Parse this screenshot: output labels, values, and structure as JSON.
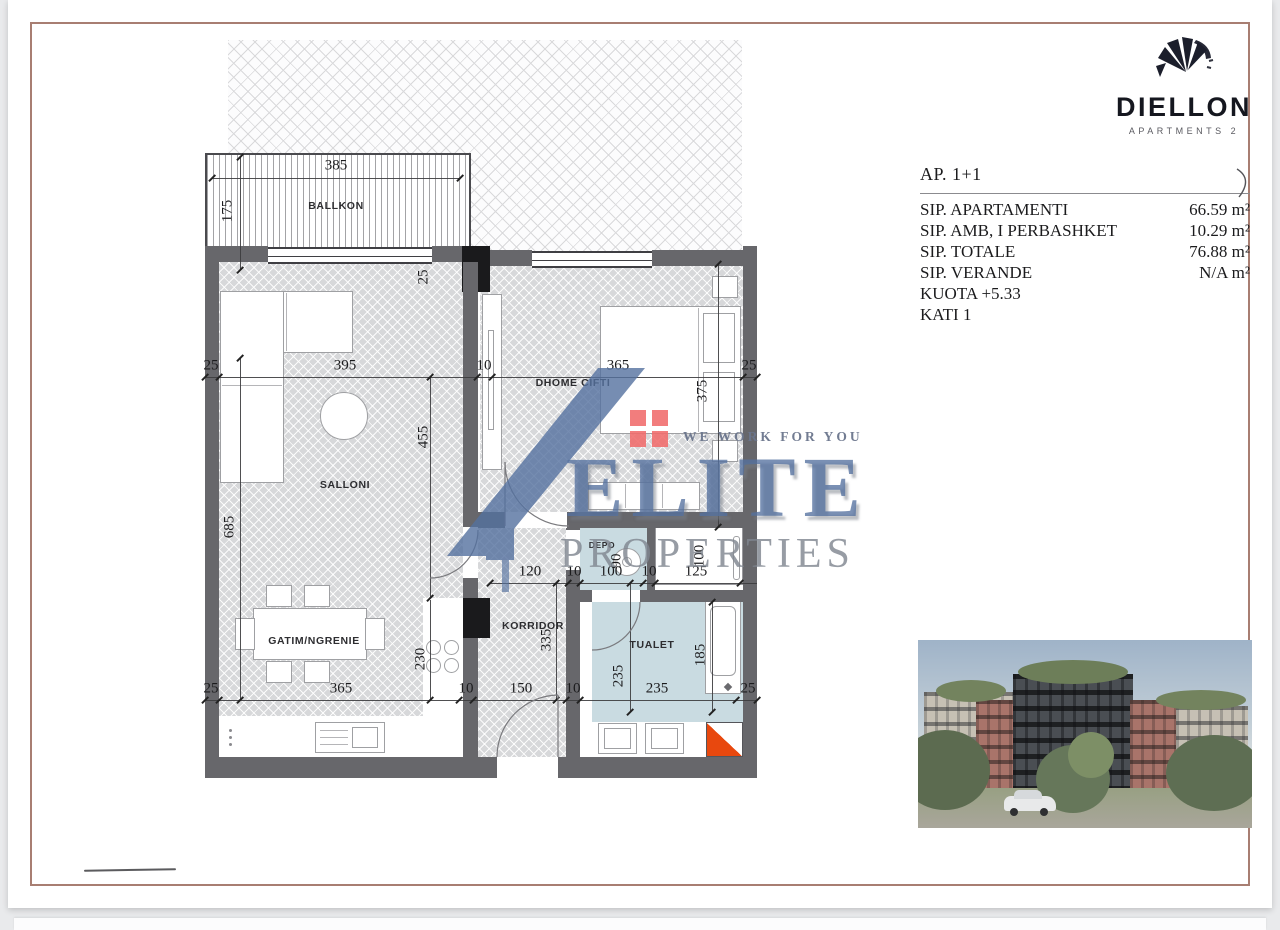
{
  "brand": {
    "name": "DIELLON",
    "sub": "APARTMENTS 2"
  },
  "info": {
    "title": "AP. 1+1",
    "rows": [
      {
        "label": "SIP. APARTAMENTI",
        "value": "66.59 m²"
      },
      {
        "label": "SIP. AMB, I PERBASHKET",
        "value": "10.29 m²"
      },
      {
        "label": "SIP. TOTALE",
        "value": "76.88 m²"
      },
      {
        "label": "SIP. VERANDE",
        "value": "N/A m²"
      }
    ],
    "kuota": "KUOTA +5.33",
    "kati": "KATI 1"
  },
  "watermark": {
    "tagline": "WE WORK FOR YOU",
    "name": "ELITE",
    "word": "PROPERTIES"
  },
  "colors": {
    "frame": "#a87e72",
    "wall": "#67676b",
    "wet_floor": "#c9dbe1",
    "shaft_orange": "#e8480e",
    "watermark_blue": "#54719f",
    "watermark_red": "#f16c6c"
  },
  "plan": {
    "rooms": [
      {
        "label": "BALLKON",
        "x": 336,
        "y": 206,
        "s": 0
      },
      {
        "label": "SALLONI",
        "x": 345,
        "y": 485,
        "s": 0
      },
      {
        "label": "GATIM/NGRENIE",
        "x": 314,
        "y": 641,
        "s": 0
      },
      {
        "label": "DHOME CIFTI",
        "x": 573,
        "y": 383,
        "s": 0
      },
      {
        "label": "KORRIDOR",
        "x": 533,
        "y": 626,
        "s": 0
      },
      {
        "label": "DEPO",
        "x": 602,
        "y": 545,
        "s": 1
      },
      {
        "label": "TUALET",
        "x": 652,
        "y": 645,
        "s": 0
      }
    ],
    "dims": [
      {
        "t": "385",
        "x": 336,
        "y": 166,
        "r": 0
      },
      {
        "t": "175",
        "x": 228,
        "y": 211,
        "r": 1
      },
      {
        "t": "25",
        "x": 211,
        "y": 366,
        "r": 0
      },
      {
        "t": "395",
        "x": 345,
        "y": 366,
        "r": 0
      },
      {
        "t": "10",
        "x": 484,
        "y": 366,
        "r": 0
      },
      {
        "t": "365",
        "x": 618,
        "y": 366,
        "r": 0
      },
      {
        "t": "25",
        "x": 749,
        "y": 366,
        "r": 0
      },
      {
        "t": "25",
        "x": 211,
        "y": 689,
        "r": 0
      },
      {
        "t": "365",
        "x": 341,
        "y": 689,
        "r": 0
      },
      {
        "t": "10",
        "x": 466,
        "y": 689,
        "r": 0
      },
      {
        "t": "150",
        "x": 521,
        "y": 689,
        "r": 0
      },
      {
        "t": "10",
        "x": 573,
        "y": 689,
        "r": 0
      },
      {
        "t": "235",
        "x": 657,
        "y": 689,
        "r": 0
      },
      {
        "t": "25",
        "x": 748,
        "y": 689,
        "r": 0
      },
      {
        "t": "120",
        "x": 530,
        "y": 572,
        "r": 0
      },
      {
        "t": "10",
        "x": 574,
        "y": 572,
        "r": 0
      },
      {
        "t": "100",
        "x": 611,
        "y": 572,
        "r": 0
      },
      {
        "t": "10",
        "x": 649,
        "y": 572,
        "r": 0
      },
      {
        "t": "125",
        "x": 696,
        "y": 572,
        "r": 0
      },
      {
        "t": "685",
        "x": 230,
        "y": 527,
        "r": 1
      },
      {
        "t": "455",
        "x": 424,
        "y": 437,
        "r": 1
      },
      {
        "t": "230",
        "x": 421,
        "y": 659,
        "r": 1
      },
      {
        "t": "335",
        "x": 547,
        "y": 640,
        "r": 1
      },
      {
        "t": "375",
        "x": 703,
        "y": 391,
        "r": 1
      },
      {
        "t": "235",
        "x": 619,
        "y": 676,
        "r": 1
      },
      {
        "t": "185",
        "x": 701,
        "y": 655,
        "r": 1
      },
      {
        "t": "90",
        "x": 617,
        "y": 561,
        "r": 1
      },
      {
        "t": "100",
        "x": 700,
        "y": 556,
        "r": 1
      },
      {
        "t": "25",
        "x": 424,
        "y": 277,
        "r": 1
      }
    ]
  }
}
